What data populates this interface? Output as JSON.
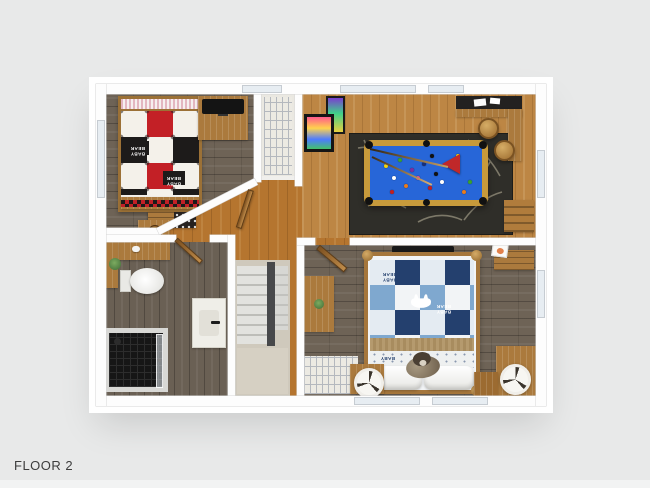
{
  "floor_label": "FLOOR 2",
  "bedroom1": {
    "quilt_text": "BABY BEAR"
  },
  "bedroom2": {
    "quilt_text": "BABY BEAR",
    "quilt_text_short": "BABY"
  },
  "palette": {
    "background": "#e8e9e9",
    "wall": "#ffffff",
    "hall_wood": "#b5752f",
    "game_room_wood": "#bd8644",
    "dark_floor_wood": "#6e6356",
    "pool_table_felt": "#2766d8",
    "pool_table_frame": "#c79a3b",
    "rug": "#2f2e29",
    "quilt1_red": "#c32026",
    "quilt1_black": "#1d1b1a",
    "quilt2_navy": "#24406e",
    "quilt2_light_blue": "#7fa8cf",
    "stair_stringer": "#47484a",
    "stair_landing": "#d6d0c3",
    "window_glass": "#e7edf2"
  }
}
